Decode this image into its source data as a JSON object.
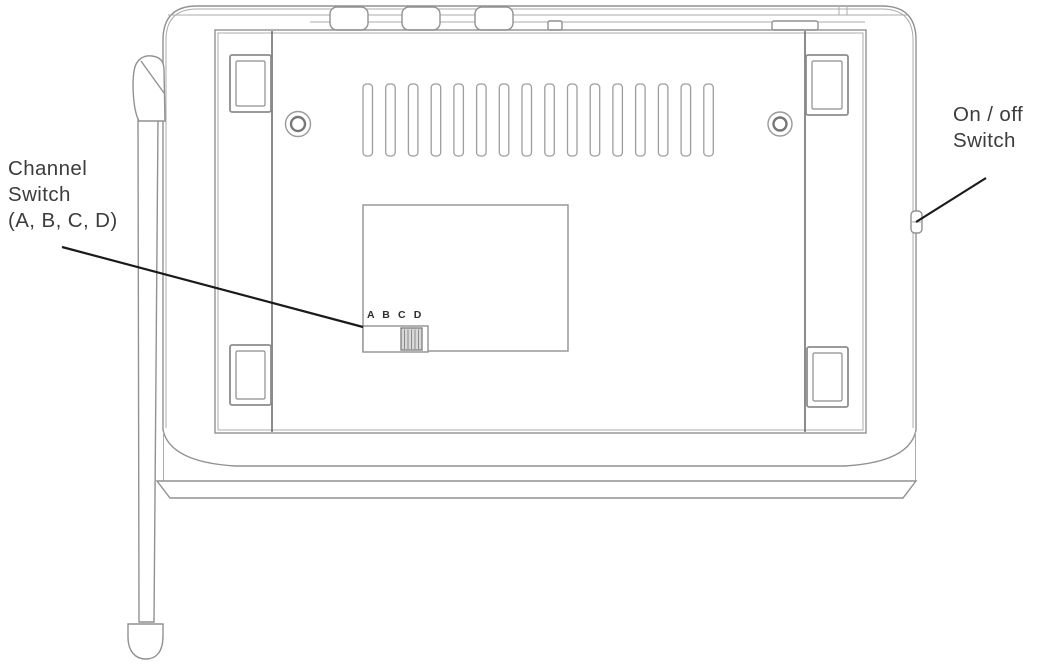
{
  "labels": {
    "channel_switch": {
      "line1": "Channel",
      "line2": "Switch",
      "line3": "(A, B, C, D)"
    },
    "on_off_switch": {
      "line1": "On / off",
      "line2": "Switch"
    }
  },
  "panel": {
    "channel_markings": "A B C D",
    "vent_slot_count": 16
  },
  "colors": {
    "background": "#ffffff",
    "outline": "#919191",
    "outline_light": "#ababab",
    "rail": "#6f6f6f",
    "leader_line": "#1a1a1a",
    "label_text": "#3c3c3c",
    "slider_fill": "#d9d9d9"
  }
}
